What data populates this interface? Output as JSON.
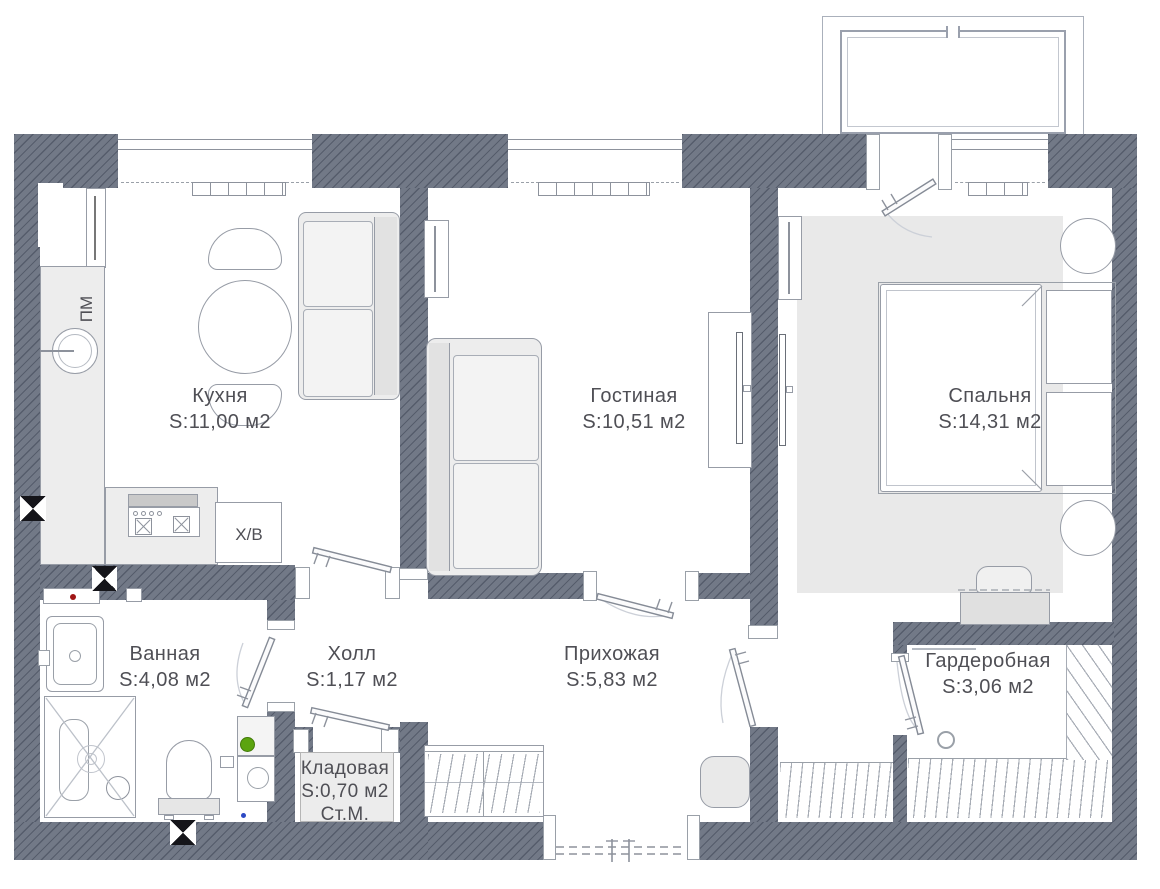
{
  "rooms": [
    {
      "id": "kitchen",
      "name": "Кухня",
      "area": "S:11,00 м2"
    },
    {
      "id": "living",
      "name": "Гостиная",
      "area": "S:10,51 м2"
    },
    {
      "id": "bedroom",
      "name": "Спальня",
      "area": "S:14,31 м2"
    },
    {
      "id": "bathroom",
      "name": "Ванная",
      "area": "S:4,08 м2"
    },
    {
      "id": "hall",
      "name": "Холл",
      "area": "S:1,17 м2"
    },
    {
      "id": "entry",
      "name": "Прихожая",
      "area": "S:5,83 м2"
    },
    {
      "id": "wardrobe",
      "name": "Гардеробная",
      "area": "S:3,06 м2"
    },
    {
      "id": "storage",
      "name": "Кладовая",
      "area": "S:0,70 м2",
      "note": "Ст.М."
    }
  ],
  "appliances": {
    "dishwasher_label": "ПМ",
    "fridge_label": "Х/В"
  },
  "markers": {
    "vent_marker_count": "3",
    "green_dot_color": "#5ba40f",
    "red_dot_color": "#a01515",
    "blue_dot_color": "#2d49c4"
  },
  "colors": {
    "wall": "#727987",
    "floor": "#ffffff",
    "furniture_outline": "#979ca6",
    "furniture_fill": "#ededed",
    "text": "#4f4f55"
  }
}
